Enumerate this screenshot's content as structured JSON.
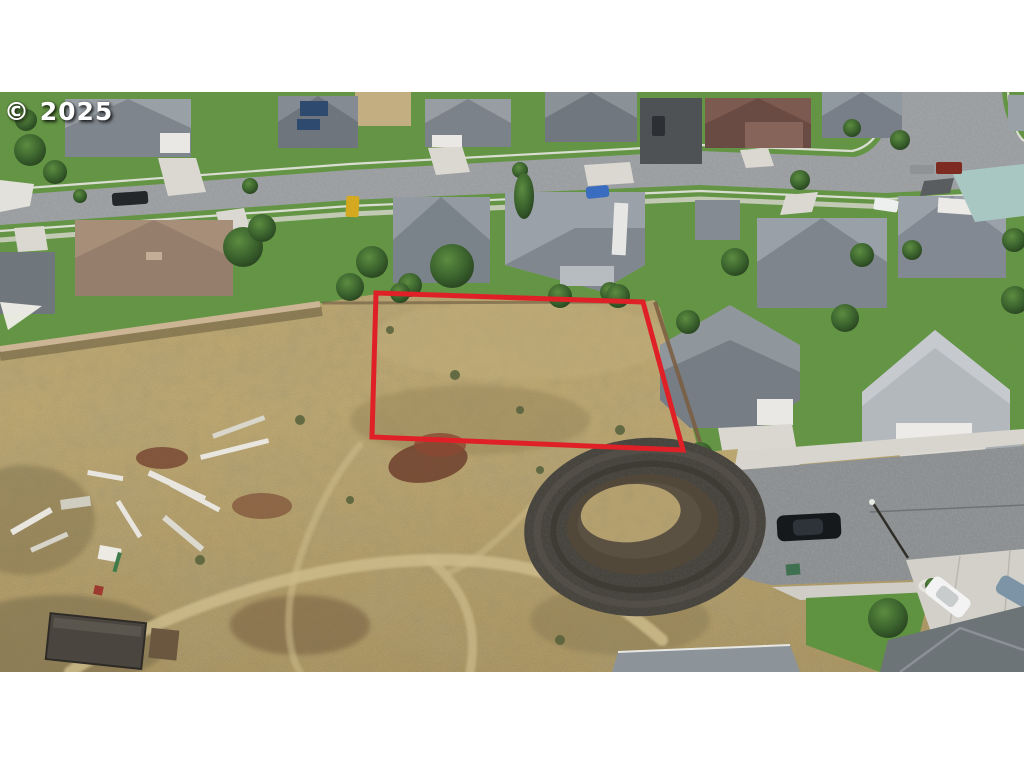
{
  "image": {
    "watermark": "© 2025",
    "kind": "aerial drone photograph",
    "subject": "Vacant residential lot outlined in red among suburban single-family homes; gray streets and lawns across the top, dark dirt cul-de-sac and street at lower right, undeveloped tan scrubland with scattered lumber debris and a trailer at lower left; white letterbox bands above and below the photo."
  },
  "lot": {
    "label": "marked vacant lot",
    "outline_points": "376,293 643,302 683,450 372,437",
    "outline_color": "#df2127",
    "outline_width": "5"
  },
  "palette": {
    "letterbox": "#ffffff",
    "scrub": "#b7a26d",
    "lawn": "#61943f",
    "street": "#9b9ea1",
    "cul_de_sac_asphalt": "#47443e",
    "concrete": "#d7d5cd",
    "roof_gray": "#939aa1",
    "roof_brown": "#a68e79",
    "roof_maroon": "#7d5a50",
    "roof_teal": "#a9c7c2",
    "watermark_color": "#ffffff"
  }
}
